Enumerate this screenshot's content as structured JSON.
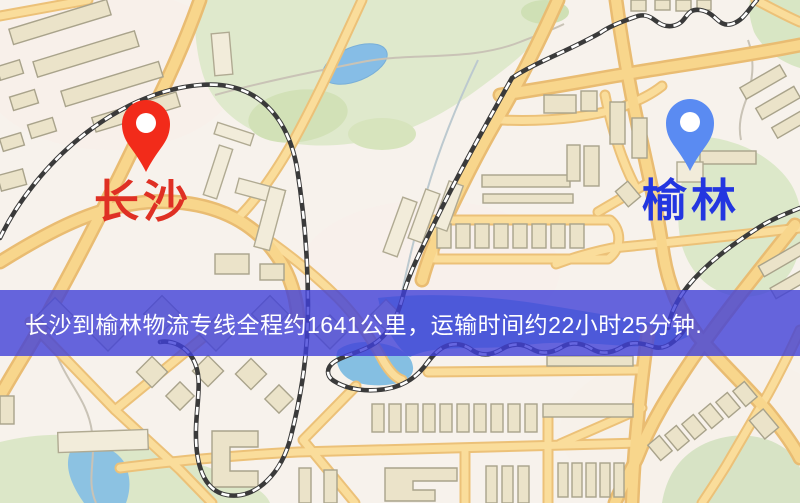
{
  "map": {
    "origin": {
      "label": "长沙"
    },
    "destination": {
      "label": "榆林"
    },
    "banner": {
      "text": "长沙到榆林物流专线全程约1641公里，运输时间约22小时25分钟."
    }
  },
  "colors": {
    "origin_pin": "#f22b1a",
    "origin_label": "#df3024",
    "destination_pin": "#5a8bf2",
    "destination_label": "#2336e0",
    "banner_background": "rgba(64,64,216,0.8)",
    "banner_text": "#ffffff"
  },
  "icons": {
    "origin_pin": "map-pin-icon",
    "destination_pin": "map-pin-icon"
  }
}
